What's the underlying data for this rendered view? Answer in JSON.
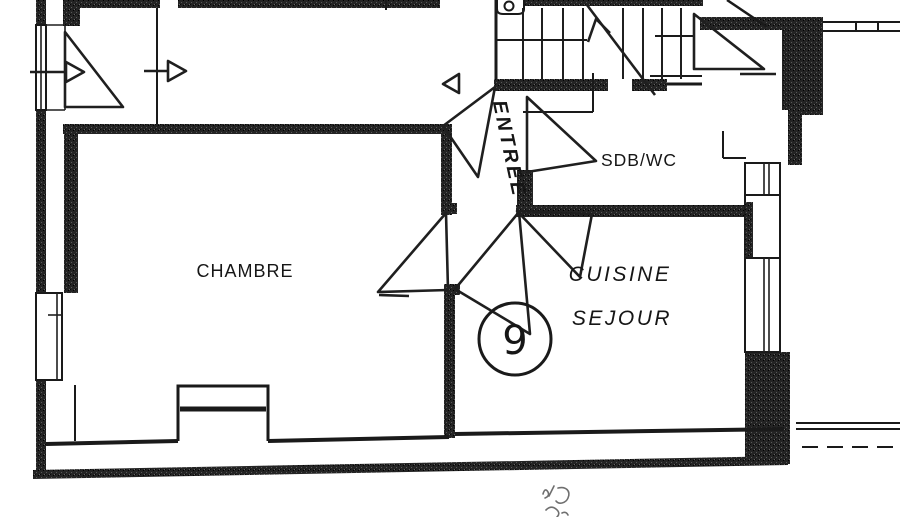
{
  "plan": {
    "rooms": {
      "chambre": {
        "label": "CHAMBRE"
      },
      "entree": {
        "label": "ENTREE"
      },
      "sdb_wc": {
        "label": "SDB/WC"
      },
      "cuisine_sejour": {
        "label_line1": "CUISINE",
        "label_line2": "SEJOUR"
      }
    },
    "unit_number": "9"
  },
  "colors": {
    "paper": "#ffffff",
    "ink": "#1a1a1a",
    "wall_fill": "#242424",
    "faint_note": "#6f6f6f"
  }
}
